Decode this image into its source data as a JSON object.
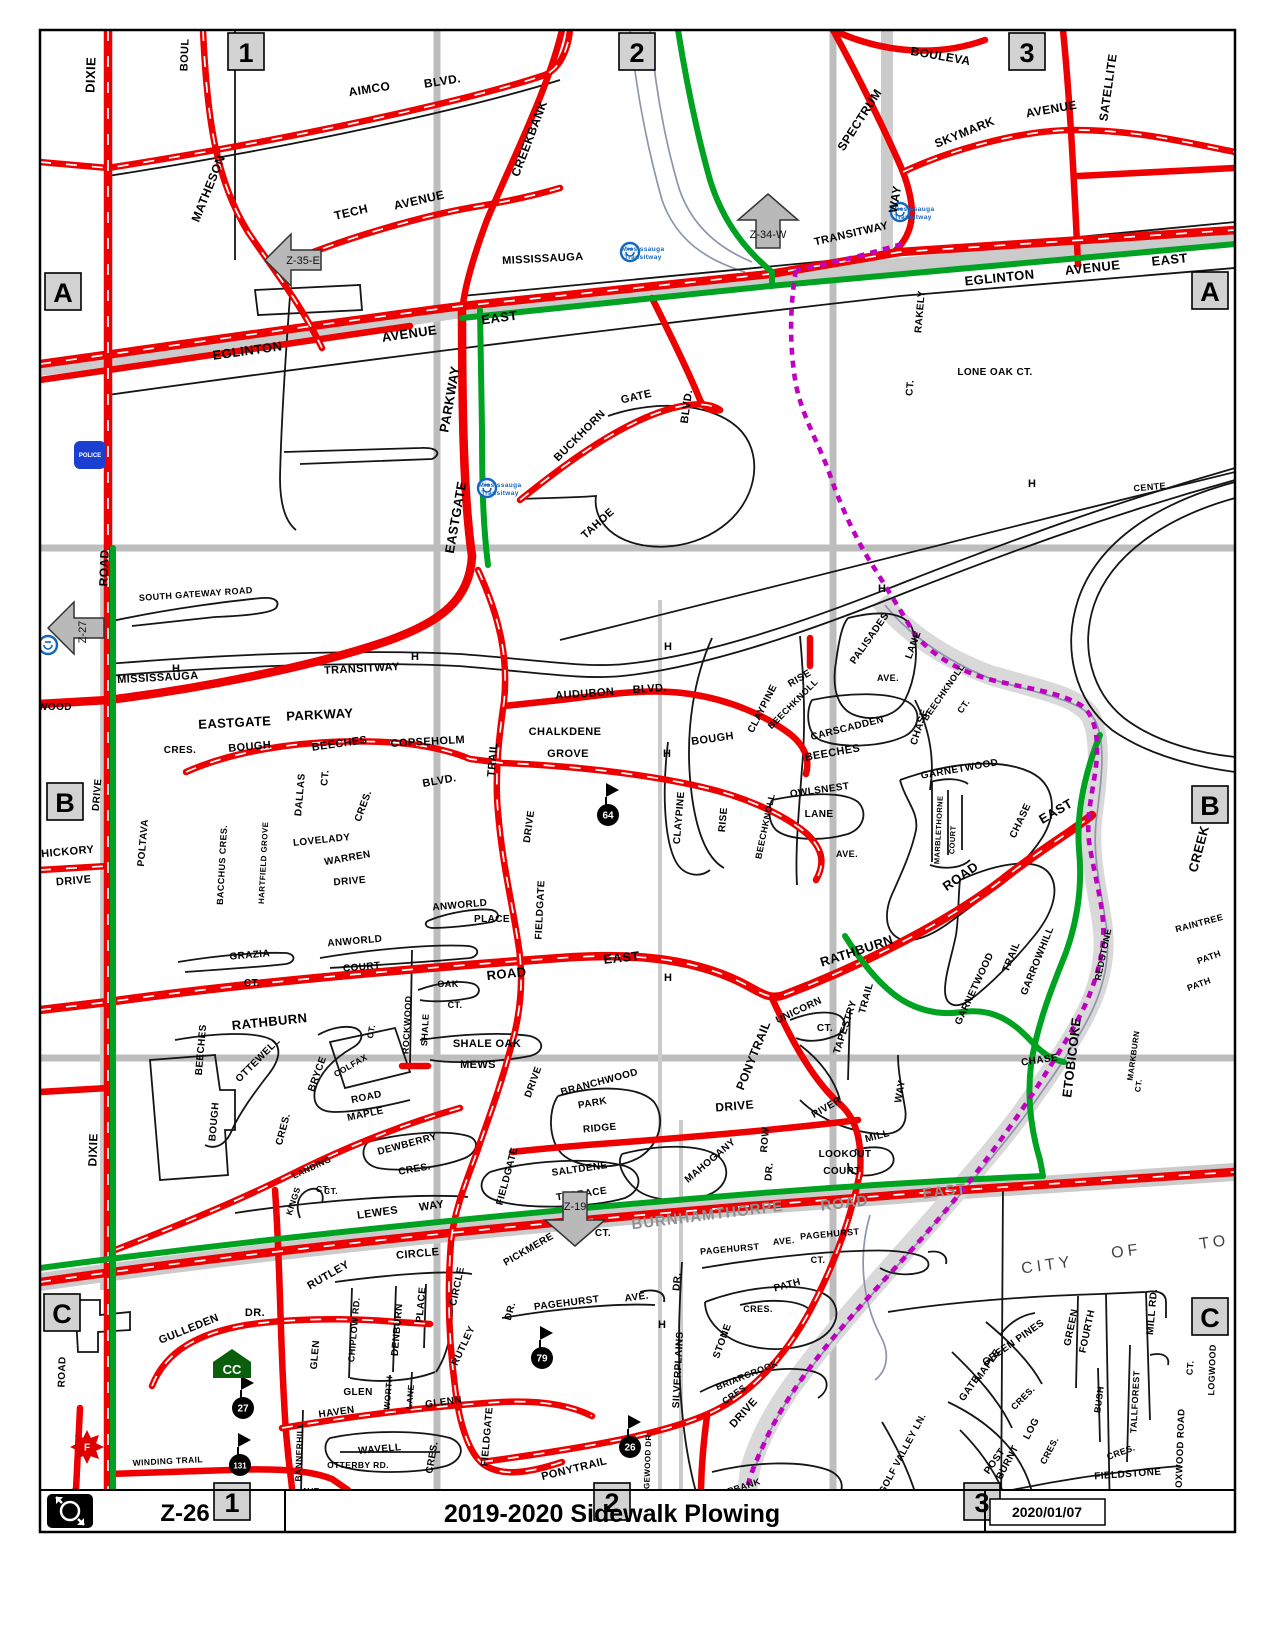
{
  "title_bar": {
    "zone_code": "Z-26",
    "title": "2019-2020 Sidewalk Plowing",
    "date": "2020/01/07",
    "logo": "winter-plow-logo"
  },
  "colors": {
    "plowed_red": "#ee0000",
    "route_green": "#00a221",
    "trail_purple": "#c000c0",
    "transit_blue": "#1566be",
    "band_gray": "#cbcbcb"
  },
  "grid_markers": [
    [
      "1",
      246,
      52
    ],
    [
      "2",
      637,
      52
    ],
    [
      "3",
      1027,
      52
    ],
    [
      "1",
      232,
      1502
    ],
    [
      "2",
      612,
      1502
    ],
    [
      "3",
      982,
      1502
    ],
    [
      "A",
      63,
      292
    ],
    [
      "A",
      1210,
      291
    ],
    [
      "B",
      65,
      802
    ],
    [
      "B",
      1210,
      805
    ],
    [
      "C",
      62,
      1313
    ],
    [
      "C",
      1210,
      1317
    ]
  ],
  "arrows": [
    {
      "label": "Z-35-E",
      "x": 295,
      "y": 260,
      "dir": "left",
      "vtext": false
    },
    {
      "label": "Z-34-W",
      "x": 768,
      "y": 224,
      "dir": "up",
      "vtext": false
    },
    {
      "label": "Z-27",
      "x": 78,
      "y": 628,
      "dir": "left",
      "vtext": true
    },
    {
      "label": "Z-19",
      "x": 575,
      "y": 1216,
      "dir": "down",
      "vtext": false
    }
  ],
  "transit_icons": [
    {
      "x": 630,
      "y": 252,
      "text": true
    },
    {
      "x": 900,
      "y": 212,
      "text": true
    },
    {
      "x": 487,
      "y": 488,
      "text": true
    },
    {
      "x": 48,
      "y": 645,
      "text": false
    }
  ],
  "transit_icon_text": [
    "Mississauga",
    "Transitway"
  ],
  "school_badges": [
    {
      "n": "64",
      "x": 608,
      "y": 815
    },
    {
      "n": "27",
      "x": 243,
      "y": 1408
    },
    {
      "n": "131",
      "x": 240,
      "y": 1465
    },
    {
      "n": "79",
      "x": 542,
      "y": 1358
    },
    {
      "n": "26",
      "x": 630,
      "y": 1447
    }
  ],
  "poi_icons": {
    "community_centre": {
      "label": "CC",
      "x": 232,
      "y": 1366
    },
    "fire_station": {
      "label": "F",
      "x": 87,
      "y": 1447
    },
    "police_station": {
      "label": "POLICE",
      "x": 90,
      "y": 455
    }
  },
  "h_markers": [
    [
      176,
      672
    ],
    [
      415,
      660
    ],
    [
      668,
      650
    ],
    [
      882,
      592
    ],
    [
      667,
      757
    ],
    [
      668,
      981
    ],
    [
      662,
      1328
    ],
    [
      635,
      1500
    ],
    [
      1032,
      487
    ]
  ],
  "labels": [
    [
      "DIXIE",
      95,
      75,
      -88,
      13
    ],
    [
      "BOUL",
      188,
      55,
      -88,
      11
    ],
    [
      "MATHESON",
      212,
      190,
      -68,
      12
    ],
    [
      "AIMCO",
      370,
      93,
      -9,
      12
    ],
    [
      "BLVD.",
      443,
      85,
      -9,
      12
    ],
    [
      "TECH",
      352,
      216,
      -13,
      12
    ],
    [
      "AVENUE",
      420,
      204,
      -13,
      12
    ],
    [
      "CREEKBANK",
      533,
      140,
      -69,
      12
    ],
    [
      "SPECTRUM",
      863,
      122,
      -57,
      12
    ],
    [
      "WAY",
      899,
      200,
      -80,
      12
    ],
    [
      "SKYMARK",
      966,
      136,
      -22,
      12
    ],
    [
      "AVENUE",
      1052,
      113,
      -10,
      12
    ],
    [
      "SATELLITE",
      1112,
      88,
      -82,
      12
    ],
    [
      "BOULEVA",
      940,
      60,
      10,
      12
    ],
    [
      "MISSISSAUGA",
      543,
      262,
      -3,
      11
    ],
    [
      "TRANSITWAY",
      852,
      237,
      -13,
      11
    ],
    [
      "EGLINTON",
      248,
      355,
      -8,
      13
    ],
    [
      "AVENUE",
      410,
      338,
      -8,
      13
    ],
    [
      "EAST",
      500,
      322,
      -8,
      13
    ],
    [
      "EGLINTON",
      1000,
      282,
      -6,
      13
    ],
    [
      "AVENUE",
      1093,
      272,
      -6,
      13
    ],
    [
      "EAST",
      1170,
      264,
      -6,
      13
    ],
    [
      "RAKELY",
      923,
      312,
      -85,
      10
    ],
    [
      "CT.",
      913,
      388,
      -85,
      10
    ],
    [
      "LONE OAK CT.",
      995,
      375,
      0,
      10
    ],
    [
      "PARKWAY",
      454,
      400,
      -80,
      13
    ],
    [
      "EASTGATE",
      460,
      518,
      -80,
      13
    ],
    [
      "BUCKHORN",
      582,
      438,
      -45,
      11
    ],
    [
      "GATE",
      637,
      400,
      -13,
      11
    ],
    [
      "BLVD.",
      690,
      407,
      -82,
      11
    ],
    [
      "TAHOE",
      600,
      526,
      -42,
      11
    ],
    [
      "ROAD",
      108,
      568,
      -88,
      12
    ],
    [
      "SOUTH GATEWAY ROAD",
      196,
      597,
      -4,
      9
    ],
    [
      "MISSISSAUGA",
      158,
      681,
      -3,
      11
    ],
    [
      "TRANSITWAY",
      362,
      672,
      -3,
      11
    ],
    [
      "EASTGATE",
      235,
      727,
      -3,
      13
    ],
    [
      "PARKWAY",
      320,
      719,
      -3,
      13
    ],
    [
      "AUDUBON",
      585,
      697,
      -4,
      11
    ],
    [
      "BLVD.",
      650,
      692,
      -4,
      11
    ],
    [
      "CHALKDENE",
      565,
      735,
      0,
      11
    ],
    [
      "GROVE",
      568,
      757,
      0,
      11
    ],
    [
      "COPSEHOLM",
      428,
      745,
      -3,
      11
    ],
    [
      "TRAIL",
      496,
      760,
      -85,
      11
    ],
    [
      "BLVD.",
      440,
      784,
      -10,
      11
    ],
    [
      "CRES.",
      180,
      753,
      0,
      10
    ],
    [
      "BOUGH",
      250,
      750,
      -5,
      11
    ],
    [
      "BEECHES",
      340,
      747,
      -8,
      11
    ],
    [
      "DALLAS",
      303,
      795,
      -85,
      10
    ],
    [
      "CT.",
      328,
      778,
      -85,
      10
    ],
    [
      "CRES.",
      366,
      807,
      -70,
      10
    ],
    [
      "POLTAVA",
      146,
      843,
      -85,
      10
    ],
    [
      "BACCHUS CRES.",
      225,
      865,
      -87,
      9
    ],
    [
      "HARTFIELD GROVE",
      266,
      863,
      -87,
      8
    ],
    [
      "LOVELADY",
      322,
      843,
      -6,
      10
    ],
    [
      "WARREN",
      348,
      861,
      -10,
      10
    ],
    [
      "DRIVE",
      350,
      884,
      -5,
      10
    ],
    [
      "WOOD",
      55,
      710,
      0,
      10
    ],
    [
      "DRIVE",
      100,
      795,
      -85,
      10
    ],
    [
      "HICKORY",
      68,
      855,
      -5,
      11
    ],
    [
      "DRIVE",
      74,
      884,
      -5,
      11
    ],
    [
      "CLAYPINE",
      765,
      710,
      -63,
      10
    ],
    [
      "RISE",
      801,
      681,
      -30,
      10
    ],
    [
      "BEECHKNOLL",
      795,
      706,
      -45,
      9
    ],
    [
      "PALISADES",
      872,
      640,
      -55,
      10
    ],
    [
      "LANE",
      916,
      646,
      -70,
      10
    ],
    [
      "AVE.",
      888,
      681,
      0,
      9
    ],
    [
      "BEECHKNOLL",
      946,
      694,
      -55,
      9
    ],
    [
      "CT.",
      966,
      708,
      -55,
      9
    ],
    [
      "CARSCADDEN",
      848,
      731,
      -14,
      10
    ],
    [
      "BOUGH",
      713,
      742,
      -8,
      11
    ],
    [
      "BEECHES",
      833,
      756,
      -10,
      11
    ],
    [
      "CLAYPINE",
      682,
      818,
      -85,
      10
    ],
    [
      "RISE",
      726,
      820,
      -85,
      10
    ],
    [
      "OWLSNEST",
      820,
      793,
      -8,
      10
    ],
    [
      "LANE",
      819,
      817,
      0,
      10
    ],
    [
      "BEECHKNOLL",
      768,
      827,
      -78,
      9
    ],
    [
      "AVE.",
      847,
      857,
      0,
      9
    ],
    [
      "CHASE",
      922,
      728,
      -72,
      10
    ],
    [
      "GARNETWOOD",
      960,
      772,
      -10,
      10
    ],
    [
      "CHASE",
      1023,
      822,
      -65,
      10
    ],
    [
      "EAST",
      1058,
      815,
      -30,
      13
    ],
    [
      "ROAD",
      963,
      880,
      -35,
      13
    ],
    [
      "RATHBURN",
      858,
      955,
      -18,
      13
    ],
    [
      "MARBLETHORNE",
      941,
      830,
      -87,
      7.5
    ],
    [
      "COURT",
      955,
      840,
      -87,
      7.5
    ],
    [
      "GARROWHILL",
      1040,
      962,
      -68,
      10
    ],
    [
      "TRAIL",
      1014,
      958,
      -68,
      10
    ],
    [
      "GARNETWOOD",
      977,
      990,
      -65,
      10
    ],
    [
      "CHASE",
      1040,
      1063,
      -8,
      10
    ],
    [
      "CREEK",
      1203,
      850,
      -75,
      13
    ],
    [
      "ETOBICOKE",
      1076,
      1058,
      -83,
      13
    ],
    [
      "REDSTONE",
      1106,
      955,
      -78,
      9
    ],
    [
      "RAINTREE",
      1200,
      926,
      -15,
      9
    ],
    [
      "PATH",
      1210,
      960,
      -20,
      9
    ],
    [
      "PATH",
      1200,
      987,
      -20,
      9
    ],
    [
      "MARKBURN",
      1136,
      1056,
      -82,
      8
    ],
    [
      "CT.",
      1141,
      1086,
      -82,
      8
    ],
    [
      "CENTE",
      1150,
      490,
      -5,
      9
    ],
    [
      "RATHBURN",
      270,
      1026,
      -6,
      13
    ],
    [
      "ROAD",
      507,
      978,
      -6,
      13
    ],
    [
      "EAST",
      622,
      962,
      -6,
      13
    ],
    [
      "GRAZIA",
      250,
      958,
      -5,
      10
    ],
    [
      "CT.",
      252,
      986,
      0,
      10
    ],
    [
      "ANWORLD",
      355,
      944,
      -5,
      10
    ],
    [
      "COURT",
      362,
      970,
      -5,
      10
    ],
    [
      "ANWORLD",
      460,
      908,
      -5,
      10
    ],
    [
      "PLACE",
      492,
      922,
      0,
      10
    ],
    [
      "ROCKWOOD",
      410,
      1025,
      -87,
      9
    ],
    [
      "SHALE",
      428,
      1030,
      -87,
      9
    ],
    [
      "OAK",
      448,
      987,
      0,
      9
    ],
    [
      "CT.",
      455,
      1008,
      0,
      9
    ],
    [
      "SHALE OAK",
      487,
      1047,
      0,
      11
    ],
    [
      "MEWS",
      478,
      1068,
      0,
      11
    ],
    [
      "DRIVE",
      532,
      827,
      -82,
      10
    ],
    [
      "FIELDGATE",
      543,
      910,
      -87,
      10
    ],
    [
      "FIELDGATE",
      510,
      1177,
      -75,
      10
    ],
    [
      "DRIVE",
      536,
      1083,
      -70,
      10
    ],
    [
      "FIELDGATE",
      490,
      1437,
      -85,
      10
    ],
    [
      "OTTEWELL",
      260,
      1062,
      -45,
      10
    ],
    [
      "CRES.",
      286,
      1130,
      -75,
      10
    ],
    [
      "BEECHES",
      204,
      1050,
      -85,
      10
    ],
    [
      "BOUGH",
      217,
      1122,
      -85,
      10
    ],
    [
      "BRYCE",
      320,
      1075,
      -70,
      10
    ],
    [
      "COLFAX",
      352,
      1068,
      -30,
      8.5
    ],
    [
      "CT.",
      374,
      1032,
      -80,
      8.5
    ],
    [
      "ROAD",
      367,
      1100,
      -12,
      10
    ],
    [
      "MAPLE",
      366,
      1117,
      -12,
      10
    ],
    [
      "DEWBERRY",
      408,
      1147,
      -15,
      10
    ],
    [
      "CRES.",
      415,
      1172,
      -10,
      10
    ],
    [
      "LANDING",
      313,
      1170,
      -25,
      8.5
    ],
    [
      "CT.",
      323,
      1192,
      0,
      8.5
    ],
    [
      "KINGS",
      296,
      1202,
      -72,
      8.5
    ],
    [
      "CT.",
      331,
      1194,
      0,
      8.5
    ],
    [
      "LEWES",
      378,
      1216,
      -8,
      11
    ],
    [
      "WAY",
      432,
      1209,
      -8,
      11
    ],
    [
      "BRANCHWOOD",
      600,
      1085,
      -15,
      10
    ],
    [
      "PARK",
      593,
      1106,
      -10,
      10
    ],
    [
      "RIDGE",
      600,
      1131,
      -5,
      10
    ],
    [
      "SALTDENE",
      580,
      1172,
      -8,
      10
    ],
    [
      "TERRACE",
      582,
      1197,
      -8,
      10
    ],
    [
      "PONYTRAIL",
      757,
      1057,
      -68,
      12
    ],
    [
      "DRIVE",
      735,
      1110,
      -5,
      12
    ],
    [
      "UNICORN",
      800,
      1013,
      -25,
      10
    ],
    [
      "CT.",
      825,
      1031,
      0,
      10
    ],
    [
      "TAPESTRY",
      848,
      1028,
      -72,
      10
    ],
    [
      "TRAIL",
      869,
      999,
      -75,
      10
    ],
    [
      "RIVER",
      828,
      1110,
      -30,
      10
    ],
    [
      "MILL",
      878,
      1139,
      -15,
      10
    ],
    [
      "WAY",
      903,
      1092,
      -80,
      10
    ],
    [
      "LOOKOUT",
      845,
      1157,
      0,
      10
    ],
    [
      "COURT",
      842,
      1174,
      0,
      10
    ],
    [
      "MAHOGANY",
      712,
      1163,
      -40,
      10
    ],
    [
      "ROW",
      768,
      1140,
      -85,
      10
    ],
    [
      "DR.",
      772,
      1172,
      -85,
      10
    ],
    [
      "BURNHAMTHORPE",
      708,
      1220,
      -7,
      15,
      "g"
    ],
    [
      "ROAD",
      845,
      1208,
      -7,
      15,
      "g"
    ],
    [
      "EAST",
      945,
      1196,
      -7,
      15,
      "g"
    ],
    [
      "PICKMERE",
      530,
      1252,
      -30,
      10
    ],
    [
      "CT.",
      603,
      1236,
      0,
      10
    ],
    [
      "PAGEHURST",
      730,
      1252,
      -5,
      9
    ],
    [
      "AVE.",
      784,
      1244,
      -5,
      9
    ],
    [
      "PAGEHURST",
      830,
      1237,
      -5,
      9
    ],
    [
      "CT.",
      818,
      1263,
      0,
      9
    ],
    [
      "DR.",
      513,
      1312,
      -75,
      10
    ],
    [
      "PAGEHURST",
      567,
      1306,
      -7,
      10
    ],
    [
      "AVE.",
      637,
      1300,
      -7,
      10
    ],
    [
      "SILVERPLAINS",
      681,
      1370,
      -87,
      10
    ],
    [
      "DR.",
      680,
      1282,
      -85,
      10
    ],
    [
      "STONE",
      725,
      1342,
      -70,
      10
    ],
    [
      "PATH",
      788,
      1288,
      -15,
      10
    ],
    [
      "CRES.",
      758,
      1312,
      0,
      9
    ],
    [
      "BRIARCROOK",
      748,
      1378,
      -22,
      9
    ],
    [
      "CRES.",
      737,
      1396,
      -35,
      9
    ],
    [
      "DRIVE",
      746,
      1415,
      -48,
      11
    ],
    [
      "STEEPBANK",
      733,
      1493,
      -18,
      9
    ],
    [
      "CRES.",
      697,
      1508,
      -55,
      9
    ],
    [
      "RIDGEWOOD DR.",
      650,
      1468,
      -88,
      8
    ],
    [
      "PONYTRAIL",
      575,
      1472,
      -14,
      11
    ],
    [
      "CRES.",
      435,
      1458,
      -80,
      10
    ],
    [
      "GULLEDEN",
      190,
      1332,
      -22,
      11
    ],
    [
      "DR.",
      255,
      1316,
      0,
      11
    ],
    [
      "GLEN",
      318,
      1355,
      -85,
      10
    ],
    [
      "CHIPLOW RD.",
      357,
      1330,
      -85,
      9
    ],
    [
      "DENBURN",
      400,
      1330,
      -85,
      10
    ],
    [
      "PLACE",
      424,
      1305,
      -85,
      10
    ],
    [
      "RUTLEY",
      330,
      1278,
      -30,
      11
    ],
    [
      "CIRCLE",
      418,
      1257,
      -5,
      11
    ],
    [
      "CIRCLE",
      460,
      1287,
      -78,
      10
    ],
    [
      "RUTLEY",
      466,
      1347,
      -65,
      10
    ],
    [
      "GLEN",
      358,
      1395,
      0,
      10
    ],
    [
      "HAVEN",
      337,
      1415,
      -8,
      10
    ],
    [
      "GLENN",
      444,
      1405,
      -8,
      10
    ],
    [
      "WORTH",
      391,
      1393,
      -85,
      8.5
    ],
    [
      "LANE",
      413,
      1397,
      -85,
      8.5
    ],
    [
      "WAVELL",
      380,
      1452,
      -5,
      10
    ],
    [
      "OTTERBY RD.",
      358,
      1468,
      0,
      8.5
    ],
    [
      "BANNERHILL",
      302,
      1452,
      -88,
      8.5
    ],
    [
      "AVE.",
      312,
      1494,
      0,
      8.5
    ],
    [
      "WINDING TRAIL",
      168,
      1464,
      -3,
      8.5
    ],
    [
      "TRAIL",
      66,
      1496,
      -5,
      10
    ],
    [
      "ROAD",
      65,
      1372,
      -88,
      10
    ],
    [
      "DIXIE",
      97,
      1150,
      -88,
      12
    ],
    [
      "CITY",
      1048,
      1270,
      -8,
      16,
      "city"
    ],
    [
      "OF",
      1127,
      1256,
      -8,
      16,
      "city"
    ],
    [
      "TO",
      1215,
      1247,
      -8,
      16,
      "city"
    ],
    [
      "MILL RD.",
      1155,
      1312,
      -85,
      10
    ],
    [
      "GREEN PINES",
      1015,
      1345,
      -35,
      10
    ],
    [
      "FOURTH",
      1090,
      1332,
      -78,
      10
    ],
    [
      "GREEN",
      1074,
      1328,
      -78,
      10
    ],
    [
      "MAPLE",
      990,
      1367,
      -55,
      10
    ],
    [
      "GATE",
      972,
      1390,
      -55,
      10
    ],
    [
      "CRES.",
      1025,
      1400,
      -45,
      9
    ],
    [
      "GOLF VALLEY LN.",
      905,
      1455,
      -62,
      9.5
    ],
    [
      "CHERRY",
      935,
      1507,
      -25,
      10
    ],
    [
      "POST",
      997,
      1463,
      -55,
      10
    ],
    [
      "BURNT",
      1010,
      1464,
      -62,
      10
    ],
    [
      "LOG",
      1034,
      1430,
      -62,
      10
    ],
    [
      "CRES.",
      1052,
      1452,
      -62,
      9
    ],
    [
      "SILVER",
      957,
      1512,
      -18,
      9
    ],
    [
      "THORNE",
      1004,
      1507,
      -18,
      9
    ],
    [
      "BUSH",
      1102,
      1400,
      -82,
      9
    ],
    [
      "TALLFOREST",
      1138,
      1402,
      -87,
      9
    ],
    [
      "CRES.",
      1122,
      1455,
      -20,
      9
    ],
    [
      "FIELDSTONE",
      1128,
      1477,
      -4,
      10
    ],
    [
      "ROAD",
      1123,
      1501,
      -4,
      10
    ],
    [
      "CT.",
      1193,
      1368,
      -85,
      9
    ],
    [
      "LOGWOOD",
      1215,
      1370,
      -88,
      9
    ],
    [
      "BOXWOOD ROAD",
      1183,
      1452,
      -88,
      9.5
    ]
  ]
}
